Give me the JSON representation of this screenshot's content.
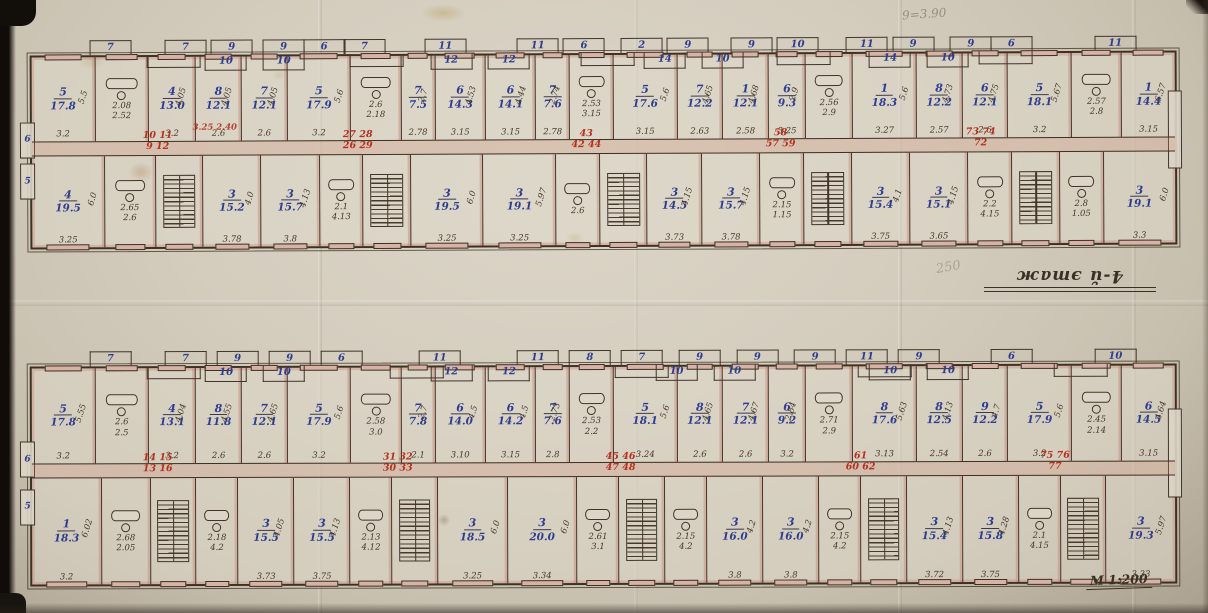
{
  "annotations": {
    "floor_label": "4-й этаж",
    "scale_label": "М 1:200",
    "pencil_top_right": "9=3.90",
    "pencil_mid": "250"
  },
  "floors": [
    {
      "id": "upper-plan",
      "end_tabs": [
        "6",
        "5"
      ],
      "balconies_top": [
        {
          "n": "7",
          "x": 7
        },
        {
          "n": "7",
          "x": 13.5
        },
        {
          "n": "9",
          "x": 17.5
        },
        {
          "n": "9",
          "x": 22
        },
        {
          "n": "6",
          "x": 25.5
        },
        {
          "n": "7",
          "x": 29
        },
        {
          "n": "11",
          "x": 36
        },
        {
          "n": "11",
          "x": 44
        },
        {
          "n": "6",
          "x": 48
        },
        {
          "n": "2",
          "x": 53
        },
        {
          "n": "9",
          "x": 57
        },
        {
          "n": "9",
          "x": 62.5
        },
        {
          "n": "10",
          "x": 66.5
        },
        {
          "n": "11",
          "x": 72.5
        },
        {
          "n": "9",
          "x": 76.5
        },
        {
          "n": "9",
          "x": 81.5
        },
        {
          "n": "6",
          "x": 85
        },
        {
          "n": "11",
          "x": 94
        }
      ],
      "balconies_bottom": [
        {
          "n": "10",
          "x": 17
        },
        {
          "n": "10",
          "x": 22
        },
        {
          "n": "12",
          "x": 36.5
        },
        {
          "n": "12",
          "x": 41.5
        },
        {
          "n": "14",
          "x": 55
        },
        {
          "n": "10",
          "x": 60
        },
        {
          "n": "14",
          "x": 74.5
        },
        {
          "n": "10",
          "x": 79.5
        }
      ],
      "red_marks": [
        {
          "l1": "10 11",
          "l2": "9 12",
          "x": 11
        },
        {
          "l1": "27 28",
          "l2": "26 29",
          "x": 28.5
        },
        {
          "l1": "43",
          "l2": "42 44",
          "x": 48.5
        },
        {
          "l1": "58",
          "l2": "57 59",
          "x": 65.5
        },
        {
          "l1": "73 74",
          "l2": "72",
          "x": 83
        }
      ],
      "red_dims": {
        "text": "3.25 2.40",
        "x": 16
      },
      "top_cells": [
        {
          "t": "r",
          "no": "5",
          "area": "17.8",
          "d1": "3.2",
          "d2": "5.5",
          "w": 9.5
        },
        {
          "t": "s",
          "labels": [
            "2.08",
            "2.52"
          ],
          "w": 8
        },
        {
          "t": "r",
          "no": "4",
          "area": "13.0",
          "d1": "3.2",
          "d2": "4.05",
          "w": 7
        },
        {
          "t": "r",
          "no": "8",
          "area": "12.1",
          "d1": "2.6",
          "d2": "4.05",
          "w": 6.8
        },
        {
          "t": "r",
          "no": "7",
          "area": "12.1",
          "d1": "2.6",
          "d2": "4.05",
          "w": 6.8
        },
        {
          "t": "r",
          "no": "5",
          "area": "17.9",
          "d1": "3.2",
          "d2": "5.6",
          "w": 9.5
        },
        {
          "t": "s",
          "labels": [
            "2.6",
            "2.18"
          ],
          "w": 7.5
        },
        {
          "t": "r",
          "no": "7",
          "area": "7.5",
          "d1": "2.78",
          "d2": "2.7",
          "w": 5
        },
        {
          "t": "r",
          "no": "6",
          "area": "14.3",
          "d1": "3.15",
          "d2": "4.53",
          "w": 7.5
        },
        {
          "t": "r",
          "no": "6",
          "area": "14.1",
          "d1": "3.15",
          "d2": "4.44",
          "w": 7.5
        },
        {
          "t": "r",
          "no": "7",
          "area": "7.6",
          "d1": "2.78",
          "d2": "2.74",
          "w": 5
        },
        {
          "t": "s",
          "labels": [
            "2.53",
            "3.15"
          ],
          "w": 6.5
        },
        {
          "t": "r",
          "no": "5",
          "area": "17.6",
          "d1": "3.15",
          "d2": "5.6",
          "w": 9.5
        },
        {
          "t": "r",
          "no": "7",
          "area": "12.2",
          "d1": "2.63",
          "d2": "4.65",
          "w": 6.8
        },
        {
          "t": "r",
          "no": "1",
          "area": "12.1",
          "d1": "2.58",
          "d2": "4.68",
          "w": 6.8
        },
        {
          "t": "r",
          "no": "6",
          "area": "9.3",
          "d1": "3.25",
          "d2": "2.9",
          "w": 5.5
        },
        {
          "t": "s",
          "labels": [
            "2.56",
            "2.9"
          ],
          "w": 7
        },
        {
          "t": "r",
          "no": "1",
          "area": "18.3",
          "d1": "3.27",
          "d2": "5.6",
          "w": 9.5
        },
        {
          "t": "r",
          "no": "8",
          "area": "12.2",
          "d1": "2.57",
          "d2": "4.73",
          "w": 6.8
        },
        {
          "t": "r",
          "no": "6",
          "area": "12.1",
          "d1": "2.6",
          "d2": "4.75",
          "w": 6.8
        },
        {
          "t": "r",
          "no": "5",
          "area": "18.1",
          "d1": "3.2",
          "d2": "5.67",
          "w": 9.5
        },
        {
          "t": "s",
          "labels": [
            "2.57",
            "2.8"
          ],
          "w": 7.5
        },
        {
          "t": "r",
          "no": "1",
          "area": "14.4",
          "d1": "3.15",
          "d2": "6.57",
          "w": 8
        }
      ],
      "bottom_cells": [
        {
          "t": "r",
          "no": "4",
          "area": "19.5",
          "d1": "3.25",
          "d2": "6.0",
          "w": 10
        },
        {
          "t": "s",
          "labels": [
            "2.65",
            "2.6"
          ],
          "w": 7
        },
        {
          "t": "st",
          "w": 6.5
        },
        {
          "t": "r",
          "no": "3",
          "area": "15.2",
          "d1": "3.78",
          "d2": "4.0",
          "w": 8
        },
        {
          "t": "r",
          "no": "3",
          "area": "15.7",
          "d1": "3.8",
          "d2": "4.13",
          "w": 8
        },
        {
          "t": "s",
          "labels": [
            "2.1",
            "4.13"
          ],
          "w": 6
        },
        {
          "t": "st",
          "w": 6.5
        },
        {
          "t": "r",
          "no": "3",
          "area": "19.5",
          "d1": "3.25",
          "d2": "6.0",
          "w": 10
        },
        {
          "t": "r",
          "no": "3",
          "area": "19.1",
          "d1": "3.25",
          "d2": "5.97",
          "w": 10
        },
        {
          "t": "s",
          "labels": [
            "2.6"
          ],
          "w": 6
        },
        {
          "t": "st",
          "w": 6.5
        },
        {
          "t": "r",
          "no": "3",
          "area": "14.5",
          "d1": "3.73",
          "d2": "4.15",
          "w": 7.5
        },
        {
          "t": "r",
          "no": "3",
          "area": "15.7",
          "d1": "3.78",
          "d2": "4.15",
          "w": 8
        },
        {
          "t": "s",
          "labels": [
            "2.15",
            "1.15"
          ],
          "w": 6
        },
        {
          "t": "st",
          "w": 6.5
        },
        {
          "t": "r",
          "no": "3",
          "area": "15.4",
          "d1": "3.75",
          "d2": "4.1",
          "w": 8
        },
        {
          "t": "r",
          "no": "3",
          "area": "15.1",
          "d1": "3.65",
          "d2": "4.15",
          "w": 8
        },
        {
          "t": "s",
          "labels": [
            "2.2",
            "4.15"
          ],
          "w": 6
        },
        {
          "t": "st",
          "w": 6.5
        },
        {
          "t": "s",
          "labels": [
            "2.8",
            "1.05"
          ],
          "w": 6
        },
        {
          "t": "r",
          "no": "3",
          "area": "19.1",
          "d1": "3.3",
          "d2": "6.0",
          "w": 10
        }
      ]
    },
    {
      "id": "lower-plan",
      "end_tabs": [
        "6",
        "5"
      ],
      "balconies_top": [
        {
          "n": "7",
          "x": 7
        },
        {
          "n": "7",
          "x": 13.5
        },
        {
          "n": "9",
          "x": 18
        },
        {
          "n": "9",
          "x": 22.5
        },
        {
          "n": "6",
          "x": 27
        },
        {
          "n": "11",
          "x": 35.5
        },
        {
          "n": "11",
          "x": 44
        },
        {
          "n": "8",
          "x": 48.5
        },
        {
          "n": "7",
          "x": 53
        },
        {
          "n": "9",
          "x": 58
        },
        {
          "n": "9",
          "x": 63
        },
        {
          "n": "9",
          "x": 68
        },
        {
          "n": "11",
          "x": 72.5
        },
        {
          "n": "9",
          "x": 77
        },
        {
          "n": "6",
          "x": 85
        },
        {
          "n": "10",
          "x": 94
        }
      ],
      "balconies_bottom": [
        {
          "n": "10",
          "x": 17
        },
        {
          "n": "10",
          "x": 22
        },
        {
          "n": "12",
          "x": 36.5
        },
        {
          "n": "12",
          "x": 41.5
        },
        {
          "n": "10",
          "x": 56
        },
        {
          "n": "10",
          "x": 61
        },
        {
          "n": "10",
          "x": 74.5
        },
        {
          "n": "10",
          "x": 79.5
        }
      ],
      "red_marks": [
        {
          "l1": "14 15",
          "l2": "13 16",
          "x": 11
        },
        {
          "l1": "31 32",
          "l2": "30 33",
          "x": 32
        },
        {
          "l1": "45 46",
          "l2": "47 48",
          "x": 51.5
        },
        {
          "l1": "61",
          "l2": "60 62",
          "x": 72.5
        },
        {
          "l1": "75 76",
          "l2": "77",
          "x": 89.5
        }
      ],
      "top_cells": [
        {
          "t": "r",
          "no": "5",
          "area": "17.8",
          "d1": "3.2",
          "d2": "5.55",
          "w": 9.5
        },
        {
          "t": "s",
          "labels": [
            "2.6",
            "2.5"
          ],
          "w": 8
        },
        {
          "t": "r",
          "no": "4",
          "area": "13.1",
          "d1": "3.2",
          "d2": "4.04",
          "w": 7
        },
        {
          "t": "r",
          "no": "8",
          "area": "11.8",
          "d1": "2.6",
          "d2": "4.55",
          "w": 6.8
        },
        {
          "t": "r",
          "no": "7",
          "area": "12.1",
          "d1": "2.6",
          "d2": "4.65",
          "w": 6.8
        },
        {
          "t": "r",
          "no": "5",
          "area": "17.9",
          "d1": "3.2",
          "d2": "5.6",
          "w": 9.5
        },
        {
          "t": "s",
          "labels": [
            "2.58",
            "3.0"
          ],
          "w": 7.5
        },
        {
          "t": "r",
          "no": "7",
          "area": "7.8",
          "d1": "2.1",
          "d2": "2.7",
          "w": 5
        },
        {
          "t": "r",
          "no": "6",
          "area": "14.0",
          "d1": "3.10",
          "d2": "4.5",
          "w": 7.5
        },
        {
          "t": "r",
          "no": "6",
          "area": "14.2",
          "d1": "3.15",
          "d2": "4.5",
          "w": 7.5
        },
        {
          "t": "r",
          "no": "7",
          "area": "7.6",
          "d1": "2.8",
          "d2": "2.73",
          "w": 5
        },
        {
          "t": "s",
          "labels": [
            "2.53",
            "2.2"
          ],
          "w": 6.5
        },
        {
          "t": "r",
          "no": "5",
          "area": "18.1",
          "d1": "3.24",
          "d2": "5.6",
          "w": 9.5
        },
        {
          "t": "r",
          "no": "8",
          "area": "12.1",
          "d1": "2.6",
          "d2": "4.65",
          "w": 6.8
        },
        {
          "t": "r",
          "no": "7",
          "area": "12.1",
          "d1": "2.6",
          "d2": "4.67",
          "w": 6.8
        },
        {
          "t": "r",
          "no": "6",
          "area": "9.2",
          "d1": "3.2",
          "d2": "2.84",
          "w": 5.5
        },
        {
          "t": "s",
          "labels": [
            "2.71",
            "2.9"
          ],
          "w": 7
        },
        {
          "t": "r",
          "no": "8",
          "area": "17.6",
          "d1": "3.13",
          "d2": "5.63",
          "w": 9.5
        },
        {
          "t": "r",
          "no": "8",
          "area": "12.5",
          "d1": "2.54",
          "d2": "4.13",
          "w": 6.8
        },
        {
          "t": "r",
          "no": "9",
          "area": "12.2",
          "d1": "2.6",
          "d2": "4.7",
          "w": 6.8
        },
        {
          "t": "r",
          "no": "5",
          "area": "17.9",
          "d1": "3.2",
          "d2": "5.6",
          "w": 9.5
        },
        {
          "t": "s",
          "labels": [
            "2.45",
            "2.14"
          ],
          "w": 7.5
        },
        {
          "t": "r",
          "no": "6",
          "area": "14.5",
          "d1": "3.15",
          "d2": "4.64",
          "w": 8
        }
      ],
      "bottom_cells": [
        {
          "t": "r",
          "no": "1",
          "area": "18.3",
          "d1": "3.2",
          "d2": "6.02",
          "w": 10
        },
        {
          "t": "s",
          "labels": [
            "2.68",
            "2.05"
          ],
          "w": 7
        },
        {
          "t": "st",
          "w": 6.5
        },
        {
          "t": "s",
          "labels": [
            "2.18",
            "4.2"
          ],
          "w": 6
        },
        {
          "t": "r",
          "no": "3",
          "area": "15.5",
          "d1": "3.73",
          "d2": "4.05",
          "w": 8
        },
        {
          "t": "r",
          "no": "3",
          "area": "15.5",
          "d1": "3.75",
          "d2": "4.13",
          "w": 8
        },
        {
          "t": "s",
          "labels": [
            "2.13",
            "4.12"
          ],
          "w": 6
        },
        {
          "t": "st",
          "w": 6.5
        },
        {
          "t": "r",
          "no": "3",
          "area": "18.5",
          "d1": "3.25",
          "d2": "6.0",
          "w": 10
        },
        {
          "t": "r",
          "no": "3",
          "area": "20.0",
          "d1": "3.34",
          "d2": "6.0",
          "w": 10
        },
        {
          "t": "s",
          "labels": [
            "2.61",
            "3.1"
          ],
          "w": 6
        },
        {
          "t": "st",
          "w": 6.5
        },
        {
          "t": "s",
          "labels": [
            "2.15",
            "4.2"
          ],
          "w": 6
        },
        {
          "t": "r",
          "no": "3",
          "area": "16.0",
          "d1": "3.8",
          "d2": "4.2",
          "w": 8
        },
        {
          "t": "r",
          "no": "3",
          "area": "16.0",
          "d1": "3.8",
          "d2": "4.2",
          "w": 8
        },
        {
          "t": "s",
          "labels": [
            "2.15",
            "4.2"
          ],
          "w": 6
        },
        {
          "t": "st",
          "w": 6.5
        },
        {
          "t": "r",
          "no": "3",
          "area": "15.4",
          "d1": "3.72",
          "d2": "4.13",
          "w": 8
        },
        {
          "t": "r",
          "no": "3",
          "area": "15.8",
          "d1": "3.75",
          "d2": "4.28",
          "w": 8
        },
        {
          "t": "s",
          "labels": [
            "2.1",
            "4.15"
          ],
          "w": 6
        },
        {
          "t": "st",
          "w": 6.5
        },
        {
          "t": "r",
          "no": "3",
          "area": "19.3",
          "d1": "3.33",
          "d2": "5.97",
          "w": 10
        }
      ]
    }
  ]
}
